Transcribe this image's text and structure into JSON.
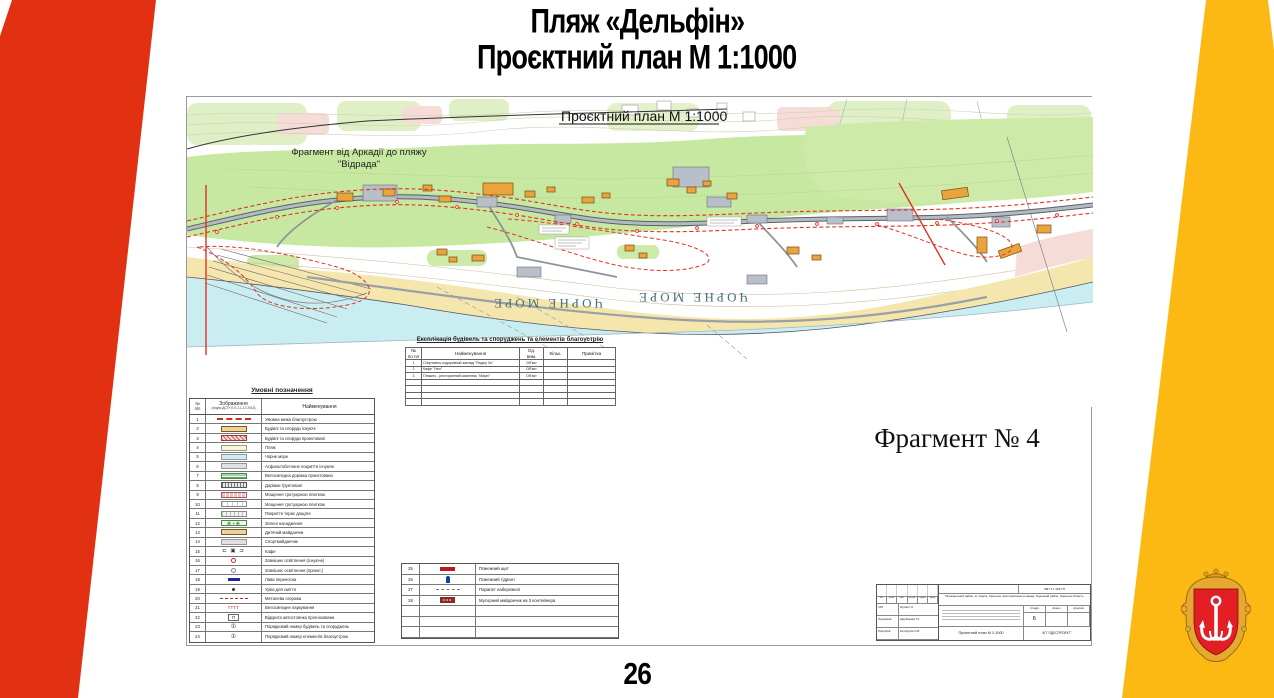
{
  "slide": {
    "title_line1": "Пляж «Дельфін»",
    "title_line2": "Проєктний план М 1:1000",
    "page_number": "26"
  },
  "map": {
    "plan_header": "Проєктний план М 1:1000",
    "fragment_note_line1": "Фрагмент  від Аркадії до пляжу",
    "fragment_note_line2": "\"Відрада\"",
    "sea_label": "ЧОРНЕ МОРЕ",
    "fragment_caption": "Фрагмент № 4"
  },
  "legend": {
    "title": "Умовні позначення",
    "col_num_line1": "№",
    "col_num_line2": "п/п",
    "col_img_line1": "Зображення",
    "col_img_line2": "(згідно ДСТУ Б Б.1.1-17:2013)",
    "col_name": "Найменування",
    "rows": [
      {
        "num": "1",
        "icon": "line-red",
        "glyph": "",
        "name": "Умовна межа благоустрою"
      },
      {
        "num": "2",
        "icon": "rect-tan",
        "glyph": "",
        "name": "Будівлі та споруди існуючі"
      },
      {
        "num": "3",
        "icon": "rect-redhatch",
        "glyph": "",
        "name": "Будівлі та споруди проектовані"
      },
      {
        "num": "4",
        "icon": "rect-paleyellow",
        "glyph": "",
        "name": "Пляж"
      },
      {
        "num": "5",
        "icon": "rect-blue",
        "glyph": "",
        "name": "Чорне море"
      },
      {
        "num": "6",
        "icon": "rect-gray",
        "glyph": "",
        "name": "Асфальтобетонне покриття існуюче"
      },
      {
        "num": "7",
        "icon": "rect-greenstripe",
        "glyph": "",
        "name": "Велосипедна доріжка проектована"
      },
      {
        "num": "8",
        "icon": "rect-darkhatch",
        "glyph": "",
        "name": "Доріжки ґрунтовані"
      },
      {
        "num": "9",
        "icon": "rect-pinktile",
        "glyph": "",
        "name": "Мощення тротуарною плиткою"
      },
      {
        "num": "10",
        "icon": "rect-tile",
        "glyph": "",
        "name": "Мощення тротуарною плиткою"
      },
      {
        "num": "11",
        "icon": "rect-plank",
        "glyph": "",
        "name": "Покриття терас дощате"
      },
      {
        "num": "12",
        "icon": "green-dots",
        "glyph": "❀ ▪ ❀",
        "name": "Зелені насадження"
      },
      {
        "num": "13",
        "icon": "rect-tan",
        "glyph": "",
        "name": "Дитячий майданчик"
      },
      {
        "num": "14",
        "icon": "rect-gray",
        "glyph": "",
        "name": "Спортмайданчик"
      },
      {
        "num": "15",
        "icon": "cafe-glyphs",
        "glyph": "⊏ ▣ ⊐",
        "name": "Кафе"
      },
      {
        "num": "16",
        "icon": "circle-red",
        "glyph": "",
        "name": "Зовнішнє освітлення (існуюче)"
      },
      {
        "num": "17",
        "icon": "circle-gray",
        "glyph": "",
        "name": "Зовнішнє освітлення (проект.)"
      },
      {
        "num": "18",
        "icon": "bench",
        "glyph": "",
        "name": "Лава переносна"
      },
      {
        "num": "19",
        "icon": "urn",
        "glyph": "",
        "name": "Урна для сміття"
      },
      {
        "num": "20",
        "icon": "fence-red",
        "glyph": "",
        "name": "Металева огорожа"
      },
      {
        "num": "21",
        "icon": "bike-red",
        "glyph": "тттт",
        "name": "Велосипедне паркування"
      },
      {
        "num": "22",
        "icon": "parking",
        "glyph": "П",
        "name": "Відкрита автостоянка прогнозована"
      },
      {
        "num": "23",
        "icon": "num-circle",
        "glyph": "①",
        "name": "Порядковий номер будівель та споруджень"
      },
      {
        "num": "24",
        "icon": "num-circle",
        "glyph": "①",
        "name": "Порядковий номер елементів благоустрою"
      }
    ]
  },
  "explication": {
    "title": "Експлікація будівель та споруджень та елементів благоустрію",
    "h_num_line1": "№",
    "h_num_line2": "по пл",
    "h_name": "Найменування",
    "h_unit_line1": "Од.",
    "h_unit_line2": "вим.",
    "h_qty": "Кільк.",
    "h_note": "Примітка",
    "rows": [
      {
        "num": "1",
        "name": "Спортивно-оздоровчий заклад \"Яндер Хо\"",
        "unit": "Об'єкт",
        "qty": "",
        "note": ""
      },
      {
        "num": "2",
        "name": "Кафе \"Нео\"",
        "unit": "Об'єкт",
        "qty": "",
        "note": ""
      },
      {
        "num": "3",
        "name": "Пляжно - ресторанний комплекс \"Мауні\"",
        "unit": "Об'єкт",
        "qty": "",
        "note": ""
      }
    ],
    "empty_rows": 4
  },
  "legend2": {
    "rows": [
      {
        "num": "25",
        "icon": "fire-shield",
        "glyph": "",
        "name": "Пожежний щит"
      },
      {
        "num": "26",
        "icon": "hydrant",
        "glyph": "",
        "name": "Пожежний гідрант"
      },
      {
        "num": "27",
        "icon": "parapet",
        "glyph": "",
        "name": "Парапет набережної"
      },
      {
        "num": "28",
        "icon": "waste",
        "glyph": "ооо",
        "name": "Мусорний майданчик на 3 контейнера"
      }
    ],
    "empty_rows": 3
  },
  "stamp": {
    "doc_code": "ЗМТ 17-103-ГП",
    "address": "Приморський район, м. Одеса, Одеська територіальна громада, Одеський район, Одеська область",
    "cols": [
      "Зм.",
      "Кільк.",
      "Арк.",
      "№ док.",
      "Підпис",
      "Дата"
    ],
    "roles": [
      {
        "role": "ГАП",
        "name": "Мурзін І.Л."
      },
      {
        "role": "Перевірив",
        "name": "Щербакова Т.К."
      },
      {
        "role": "Розробив",
        "name": "Колобухов О.В."
      }
    ],
    "stage_label": "Стадія",
    "sheet_label": "Аркуш",
    "sheets_label": "Аркушів",
    "stage_value": "Б",
    "sheet_title": "Проєктний план М 1:1000",
    "org": "КП \"ОДЕСПРОЕКТ\""
  },
  "colors": {
    "accent_red": "#E23012",
    "accent_yellow": "#FDB913",
    "sea": "#C9EDF0",
    "sand": "#F4E6AD",
    "vegetation": "#C6E8A0",
    "boundary_red": "#E23222"
  }
}
